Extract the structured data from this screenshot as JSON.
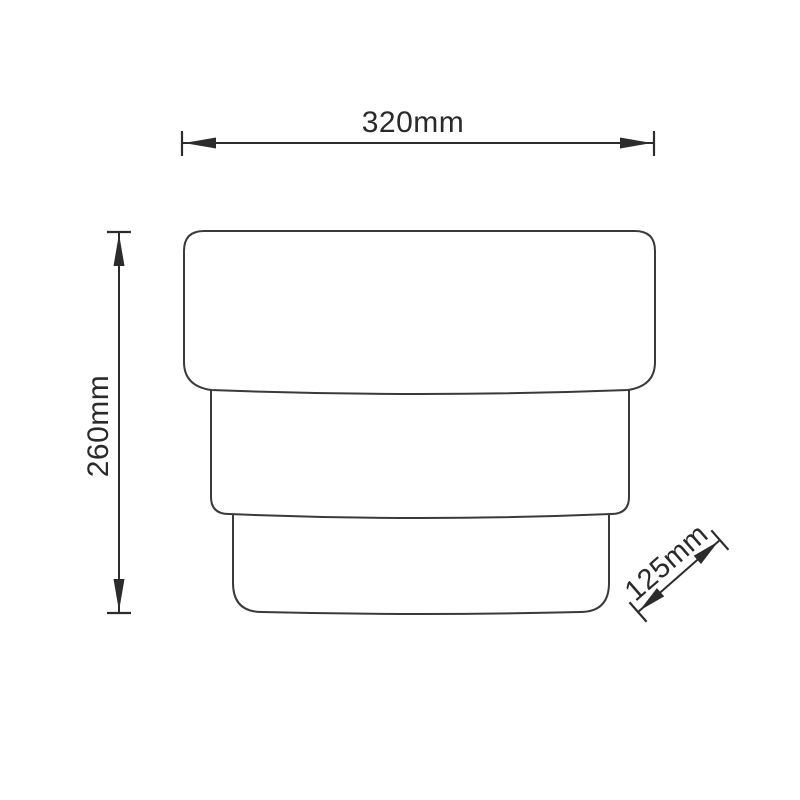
{
  "diagram": {
    "description": "Technical dimension drawing of a three-tier stepped product (side view)",
    "colors": {
      "background": "#ffffff",
      "outline": "#3a3a3a",
      "dimension_line": "#2c2c2c",
      "text": "#2a2a2a"
    },
    "dimensions": {
      "width": "320mm",
      "height": "260mm",
      "depth": "125mm"
    }
  }
}
